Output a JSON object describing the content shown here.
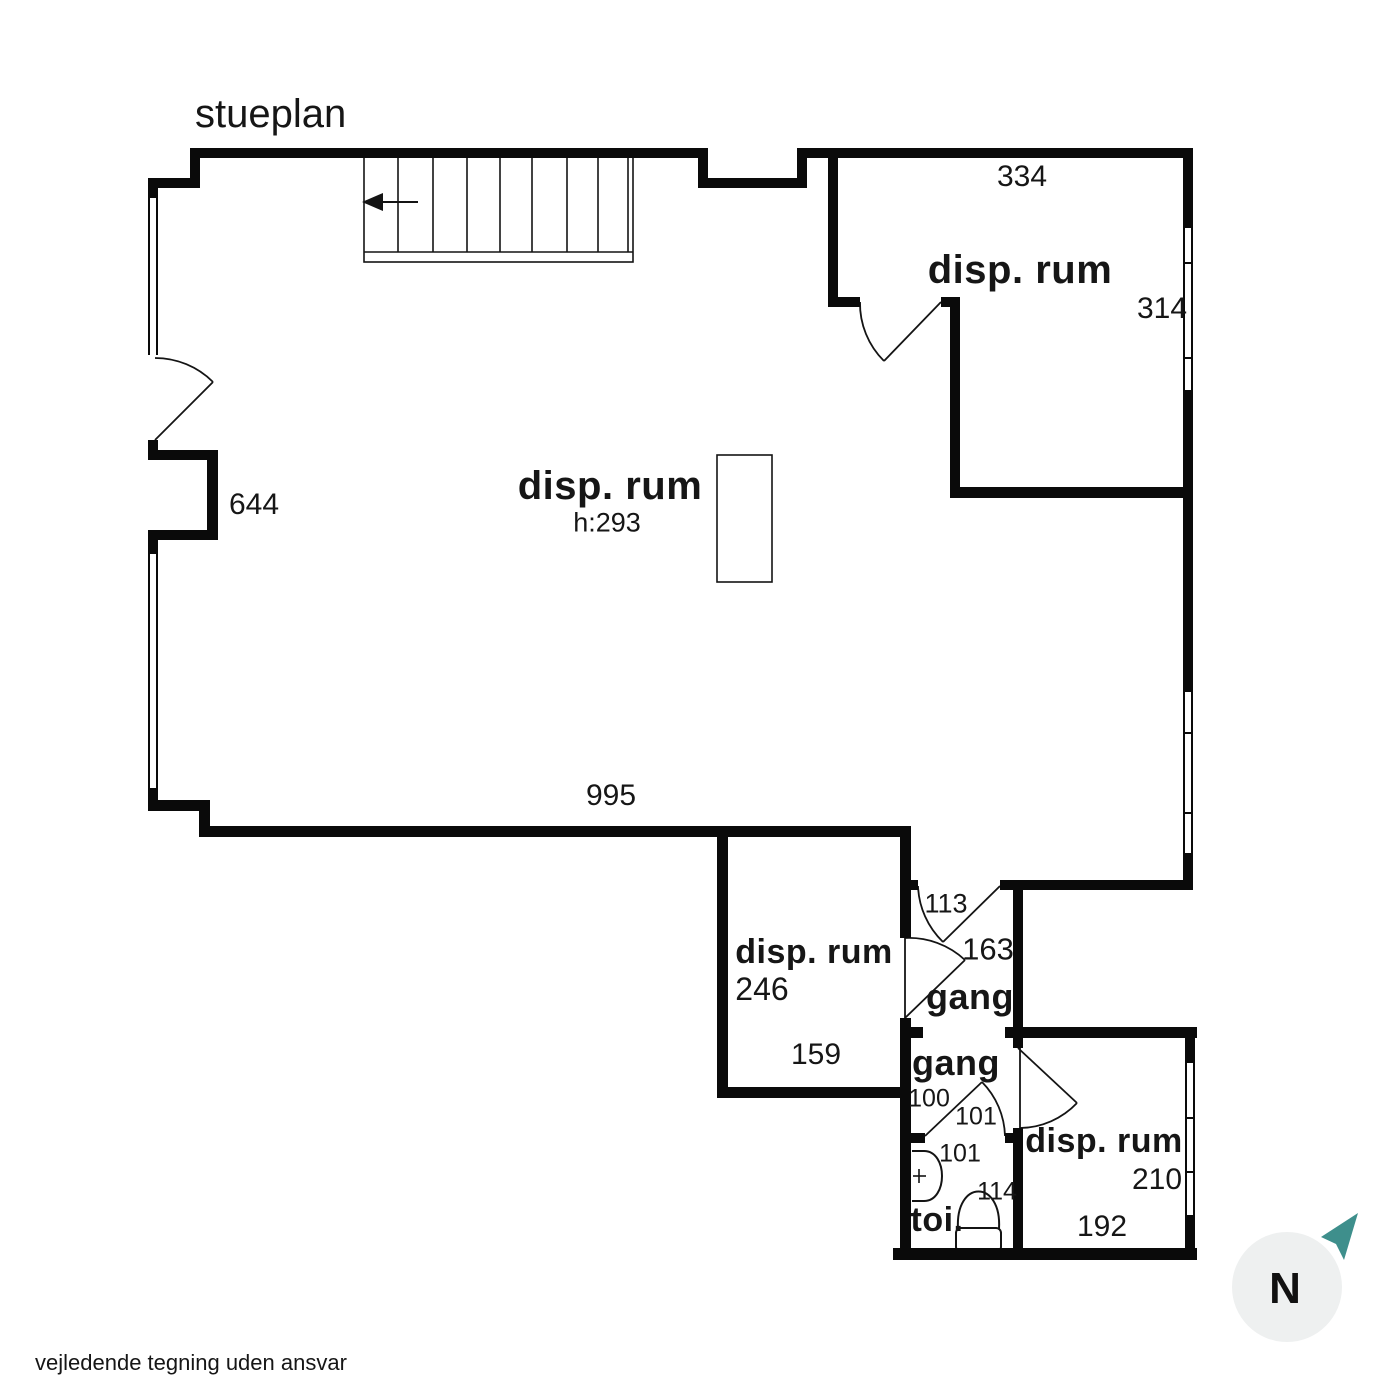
{
  "title": "stueplan",
  "footer": "vejledende tegning uden ansvar",
  "compass": {
    "label": "N"
  },
  "labels": {
    "main_room": {
      "name": "disp. rum",
      "height": "h:293",
      "dim_side": "644",
      "dim_bottom": "995"
    },
    "top_right_room": {
      "name": "disp. rum",
      "dim_top": "334",
      "dim_right": "314"
    },
    "mid_bottom_room": {
      "name": "disp. rum",
      "area": "246",
      "dim_bottom": "159"
    },
    "gang_upper": {
      "name": "gang",
      "dim_door": "113",
      "dim_len": "163"
    },
    "gang_lower": {
      "name": "gang",
      "dim_a": "100",
      "dim_b": "101"
    },
    "toilet": {
      "name": "toi.",
      "dim_a": "101",
      "dim_b": "114"
    },
    "bottom_right_room": {
      "name": "disp. rum",
      "dim_right": "210",
      "dim_bottom": "192"
    }
  },
  "colors": {
    "wall": "#0a0a0a",
    "compass_arrow": "#3e8f8c",
    "compass_circle": "#eef0f0"
  }
}
